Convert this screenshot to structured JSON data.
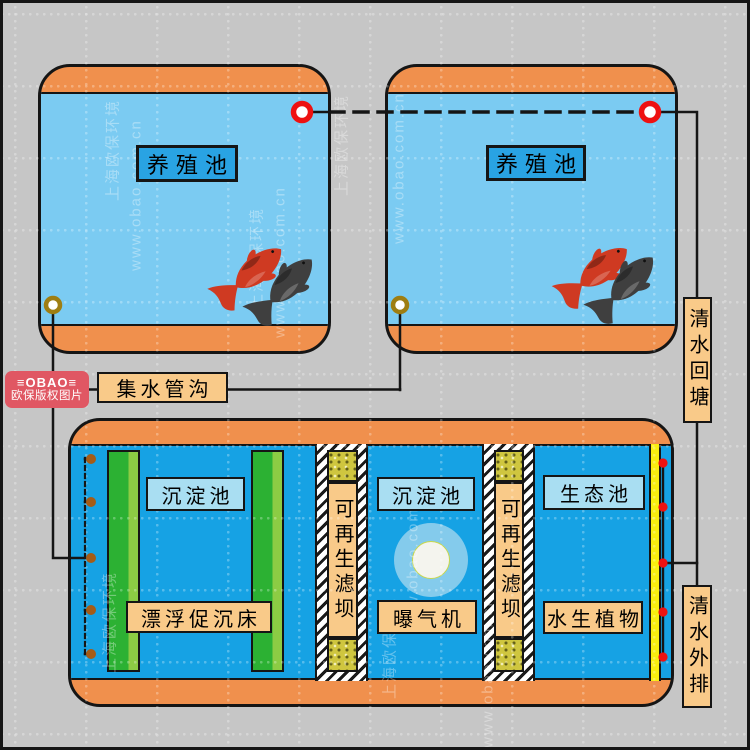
{
  "labels": {
    "pond1": "养殖池",
    "pond2": "养殖池",
    "collector_pipe": "集水管沟",
    "clear_water_return": "清水回塘",
    "clear_water_discharge": "清水外排",
    "sedimentation1": "沉淀池",
    "floating_bed": "漂浮促沉床",
    "filter_dam1": "可再生滤坝",
    "sedimentation2": "沉淀池",
    "aerator": "曝气机",
    "filter_dam2": "可再生滤坝",
    "eco_pond": "生态池",
    "aquatic_plants": "水生植物"
  },
  "watermark": {
    "brand_text": "上海欧保环境",
    "url_text": "www.obao.com.cn",
    "logo_title": "≡OBAO≡",
    "logo_subtitle": "欧保版权图片"
  },
  "colors": {
    "pond_water": "#7bcbf2",
    "treatment_water": "#16a2e4",
    "tank_rim": "#f0904d",
    "label_tan": "#f9ca89",
    "label_blue": "#a9def2",
    "pond_label_blue": "#29a3e3",
    "valve_red": "#ee1111",
    "valve_olive": "#9e7e12",
    "port_brown": "#a55c17",
    "dam_media_yellow": "#cfc63f",
    "green_dark": "#2cb133",
    "green_light": "#8ccc44",
    "overflow_yellow": "#f9ee0f",
    "logo_red": "#e05763"
  }
}
